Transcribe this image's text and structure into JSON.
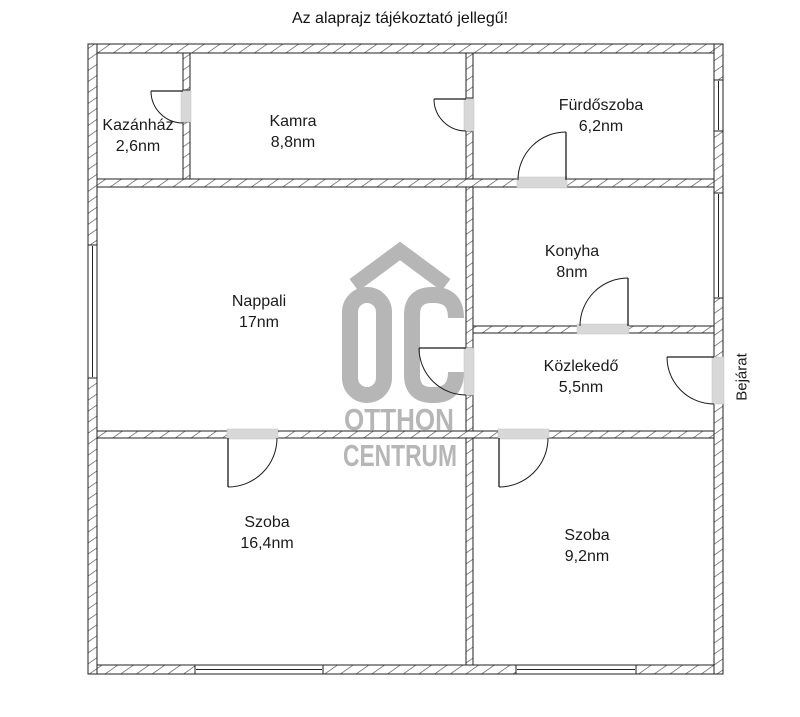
{
  "title": "Az alaprajz tájékoztató jellegű!",
  "entrance": {
    "label": "Bejárat"
  },
  "watermark": {
    "monogram": "OC",
    "name_line1": "OTTHON",
    "name_line2": "CENTRUM",
    "color": "#b6b6b6"
  },
  "rooms": [
    {
      "name": "Kazánház",
      "area": "2,6nm"
    },
    {
      "name": "Kamra",
      "area": "8,8nm"
    },
    {
      "name": "Fürdőszoba",
      "area": "6,2nm"
    },
    {
      "name": "Nappali",
      "area": "17nm"
    },
    {
      "name": "Konyha",
      "area": "8nm"
    },
    {
      "name": "Közlekedő",
      "area": "5,5nm"
    },
    {
      "name": "Szoba",
      "area": "16,4nm"
    },
    {
      "name": "Szoba",
      "area": "9,2nm"
    }
  ]
}
